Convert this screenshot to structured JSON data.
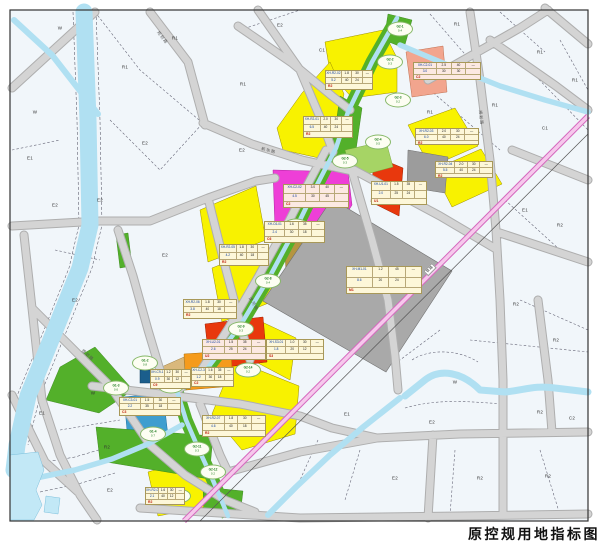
{
  "caption": "原控规用地指标图",
  "railway": {
    "label": "铁路"
  },
  "colors": {
    "background": "#f1f6fa",
    "residential_yellow": "#f8f200",
    "commercial_magenta": "#ee3fd7",
    "red_parcel": "#e8380d",
    "salmon_parcel": "#f2a58e",
    "orange_parcel": "#f59b1c",
    "tan_parcel": "#d9b87c",
    "olive_parcel": "#b5953f",
    "industrial_gray": "#a9a9a9",
    "blue_parcel": "#3f9ecf",
    "navy_parcel": "#1b5e8c",
    "green_space": "#53b02a",
    "light_green": "#a6d465",
    "water_blue": "#b0e0f2",
    "road_gray": "#d2d2d2",
    "railway_pink": "#f0aade",
    "label_box_cream": "#fdf7d9"
  },
  "road_names": [
    {
      "x": 262,
      "y": 146,
      "r": 14,
      "t": "新华路"
    },
    {
      "x": 252,
      "y": 296,
      "r": 58,
      "t": "滨河路"
    },
    {
      "x": 84,
      "y": 348,
      "r": 42,
      "t": "规划路"
    },
    {
      "x": 483,
      "y": 110,
      "r": 84,
      "t": "规划路"
    },
    {
      "x": 160,
      "y": 30,
      "r": 52,
      "t": "规划路"
    }
  ],
  "parcel_codes": [
    {
      "x": 175,
      "y": 38,
      "t": "R1"
    },
    {
      "x": 243,
      "y": 84,
      "t": "R1"
    },
    {
      "x": 125,
      "y": 67,
      "t": "R1"
    },
    {
      "x": 145,
      "y": 143,
      "t": "E2"
    },
    {
      "x": 30,
      "y": 158,
      "t": "E1"
    },
    {
      "x": 35,
      "y": 112,
      "t": "W"
    },
    {
      "x": 60,
      "y": 28,
      "t": "W"
    },
    {
      "x": 100,
      "y": 200,
      "t": "E2"
    },
    {
      "x": 242,
      "y": 150,
      "t": "E2"
    },
    {
      "x": 280,
      "y": 25,
      "t": "E2"
    },
    {
      "x": 322,
      "y": 50,
      "t": "C1"
    },
    {
      "x": 457,
      "y": 24,
      "t": "R1"
    },
    {
      "x": 540,
      "y": 52,
      "t": "R1"
    },
    {
      "x": 575,
      "y": 80,
      "t": "R1"
    },
    {
      "x": 495,
      "y": 105,
      "t": "R1"
    },
    {
      "x": 430,
      "y": 112,
      "t": "R1"
    },
    {
      "x": 545,
      "y": 128,
      "t": "C1"
    },
    {
      "x": 525,
      "y": 210,
      "t": "E1"
    },
    {
      "x": 560,
      "y": 225,
      "t": "R2"
    },
    {
      "x": 516,
      "y": 304,
      "t": "R2"
    },
    {
      "x": 556,
      "y": 340,
      "t": "R2"
    },
    {
      "x": 540,
      "y": 412,
      "t": "R2"
    },
    {
      "x": 572,
      "y": 418,
      "t": "C2"
    },
    {
      "x": 480,
      "y": 478,
      "t": "R2"
    },
    {
      "x": 548,
      "y": 476,
      "t": "R2"
    },
    {
      "x": 432,
      "y": 422,
      "t": "E2"
    },
    {
      "x": 347,
      "y": 414,
      "t": "E1"
    },
    {
      "x": 395,
      "y": 478,
      "t": "E2"
    },
    {
      "x": 455,
      "y": 382,
      "t": "W"
    },
    {
      "x": 42,
      "y": 413,
      "t": "E1"
    },
    {
      "x": 107,
      "y": 447,
      "t": "R2"
    },
    {
      "x": 110,
      "y": 490,
      "t": "E2"
    },
    {
      "x": 93,
      "y": 393,
      "t": "W"
    },
    {
      "x": 75,
      "y": 300,
      "t": "E2"
    },
    {
      "x": 55,
      "y": 205,
      "t": "E2"
    },
    {
      "x": 165,
      "y": 255,
      "t": "E2"
    }
  ],
  "green_ellipses": [
    {
      "x": 400,
      "y": 29,
      "a": "G2-1",
      "b": "0.4"
    },
    {
      "x": 390,
      "y": 62,
      "a": "G2-2",
      "b": "0.3"
    },
    {
      "x": 398,
      "y": 100,
      "a": "G2-3",
      "b": "0.2"
    },
    {
      "x": 378,
      "y": 142,
      "a": "G2-4",
      "b": "0.5"
    },
    {
      "x": 345,
      "y": 161,
      "a": "G2-5",
      "b": "0.3"
    },
    {
      "x": 318,
      "y": 196,
      "a": "G2-6",
      "b": "0.2"
    },
    {
      "x": 296,
      "y": 226,
      "a": "G2-7",
      "b": "0.3"
    },
    {
      "x": 268,
      "y": 281,
      "a": "G2-8",
      "b": "0.4"
    },
    {
      "x": 241,
      "y": 329,
      "a": "G2-9",
      "b": "0.3"
    },
    {
      "x": 210,
      "y": 374,
      "a": "G2-10",
      "b": "0.2"
    },
    {
      "x": 171,
      "y": 386,
      "a": "G1-1",
      "b": "1.2"
    },
    {
      "x": 197,
      "y": 449,
      "a": "G2-11",
      "b": "0.3"
    },
    {
      "x": 213,
      "y": 472,
      "a": "G2-12",
      "b": "0.2"
    },
    {
      "x": 145,
      "y": 363,
      "a": "G1-2",
      "b": "0.8"
    },
    {
      "x": 116,
      "y": 388,
      "a": "G1-3",
      "b": "0.6"
    },
    {
      "x": 153,
      "y": 434,
      "a": "G1-4",
      "b": "0.7"
    },
    {
      "x": 178,
      "y": 496,
      "a": "G2-13",
      "b": "0.3"
    },
    {
      "x": 248,
      "y": 370,
      "a": "G2-14",
      "b": "0.2"
    }
  ],
  "indicator_boxes": [
    {
      "x": 303,
      "y": 116,
      "w": 48,
      "h": 20,
      "code": "XH-R2-01",
      "v": [
        "2.0",
        "30",
        "—",
        "6.5",
        "40",
        "24"
      ],
      "use": "R2",
      "pink": false
    },
    {
      "x": 325,
      "y": 70,
      "w": 46,
      "h": 18,
      "code": "XH-R2-02",
      "v": [
        "1.8",
        "30",
        "—",
        "5.2",
        "40",
        "24"
      ],
      "use": "R2",
      "pink": false
    },
    {
      "x": 413,
      "y": 62,
      "w": 66,
      "h": 16,
      "code": "XH-C2-01",
      "v": [
        "2.5",
        "40",
        "—",
        "3.0",
        "30",
        "30"
      ],
      "use": "C2",
      "pink": true
    },
    {
      "x": 283,
      "y": 184,
      "w": 64,
      "h": 22,
      "code": "XH-C2-02",
      "v": [
        "3.0",
        "40",
        "—",
        "4.5",
        "30",
        "45"
      ],
      "use": "C2",
      "pink": true
    },
    {
      "x": 415,
      "y": 128,
      "w": 62,
      "h": 15,
      "code": "XH-R2-03",
      "v": [
        "2.0",
        "30",
        "—",
        "6.0",
        "40",
        "24"
      ],
      "use": "R2",
      "pink": false
    },
    {
      "x": 435,
      "y": 161,
      "w": 56,
      "h": 15,
      "code": "XH-R2-04",
      "v": [
        "2.0",
        "30",
        "—",
        "5.5",
        "40",
        "24"
      ],
      "use": "R2",
      "pink": false
    },
    {
      "x": 371,
      "y": 181,
      "w": 54,
      "h": 22,
      "code": "XH-U1-01",
      "v": [
        "1.5",
        "35",
        "—",
        "2.0",
        "25",
        "24"
      ],
      "use": "U1",
      "pink": false
    },
    {
      "x": 346,
      "y": 266,
      "w": 74,
      "h": 26,
      "code": "XH-M1-01",
      "v": [
        "1.2",
        "45",
        "—",
        "8.6",
        "20",
        "24"
      ],
      "use": "M1",
      "pink": false
    },
    {
      "x": 264,
      "y": 221,
      "w": 59,
      "h": 20,
      "code": "XH-C6-01",
      "v": [
        "1.6",
        "35",
        "—",
        "2.4",
        "30",
        "18"
      ],
      "use": "C6",
      "pink": false
    },
    {
      "x": 219,
      "y": 244,
      "w": 48,
      "h": 20,
      "code": "XH-R2-05",
      "v": [
        "1.8",
        "30",
        "—",
        "4.2",
        "40",
        "18"
      ],
      "use": "R2",
      "pink": false
    },
    {
      "x": 183,
      "y": 299,
      "w": 52,
      "h": 18,
      "code": "XH-R2-06",
      "v": [
        "1.8",
        "30",
        "—",
        "3.8",
        "40",
        "18"
      ],
      "use": "R2",
      "pink": false
    },
    {
      "x": 202,
      "y": 339,
      "w": 62,
      "h": 19,
      "code": "XH-U2-01",
      "v": [
        "1.5",
        "35",
        "—",
        "2.6",
        "25",
        "24"
      ],
      "use": "U2",
      "pink": true
    },
    {
      "x": 266,
      "y": 339,
      "w": 56,
      "h": 19,
      "code": "XH-S3-01",
      "v": [
        "1.0",
        "30",
        "—",
        "1.8",
        "20",
        "12"
      ],
      "use": "S3",
      "pink": false
    },
    {
      "x": 150,
      "y": 369,
      "w": 39,
      "h": 18,
      "code": "XH-C9-1",
      "v": [
        "1.2",
        "30",
        "—",
        "0.9",
        "30",
        "12"
      ],
      "use": "C9",
      "pink": false
    },
    {
      "x": 191,
      "y": 367,
      "w": 41,
      "h": 18,
      "code": "XH-C2-3",
      "v": [
        "1.6",
        "35",
        "—",
        "1.2",
        "30",
        "18"
      ],
      "use": "C2",
      "pink": false
    },
    {
      "x": 119,
      "y": 397,
      "w": 60,
      "h": 17,
      "code": "XH-C3-01",
      "v": [
        "1.5",
        "30",
        "—",
        "2.2",
        "35",
        "18"
      ],
      "use": "C3",
      "pink": false
    },
    {
      "x": 202,
      "y": 415,
      "w": 62,
      "h": 20,
      "code": "XH-R2-07",
      "v": [
        "1.8",
        "30",
        "—",
        "4.6",
        "40",
        "18"
      ],
      "use": "R2",
      "pink": false
    },
    {
      "x": 145,
      "y": 487,
      "w": 38,
      "h": 16,
      "code": "XH-R2-08",
      "v": [
        "1.6",
        "30",
        "—",
        "2.1",
        "40",
        "12"
      ],
      "use": "R2",
      "pink": false
    }
  ]
}
